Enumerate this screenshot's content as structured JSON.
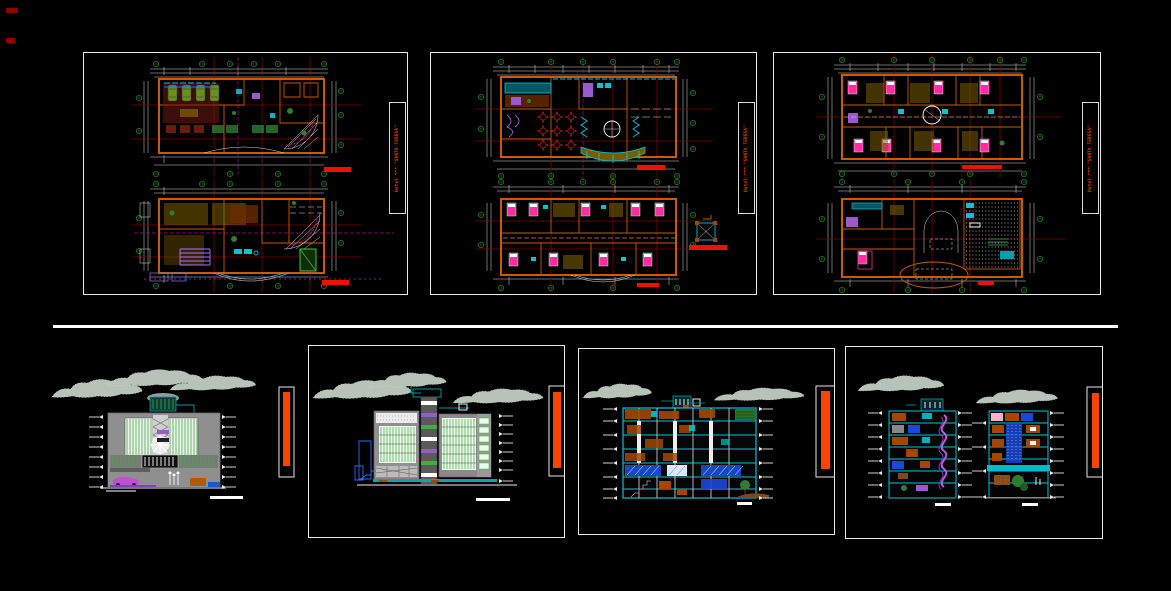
{
  "sheets": [
    {
      "title": "Hotel *** \"SANTA TERESA\""
    },
    {
      "title": "Hotel *** \"SANTA TERESA\""
    },
    {
      "title": "Hotel *** \"SANTA TERESA\""
    }
  ],
  "colors": {
    "background": "#000000",
    "panel_border": "#e8e8e8",
    "divider": "#ffffff",
    "sheet_title_red": "#ff3b00",
    "scale_bar_red": "#ee1000",
    "elevation_bar_orange": "#fb4400",
    "wall_orange": "#cd5a00",
    "grid_maroon": "#7c0006",
    "grid_bubble_green": "#1f7a1f",
    "dimension_white": "#d9d9d9",
    "section_cyan": "#00c3d4",
    "furniture_magenta": "#ff2da0",
    "stair_purple": "#9b59d0",
    "cloud_gray": "#b7c3b9"
  }
}
